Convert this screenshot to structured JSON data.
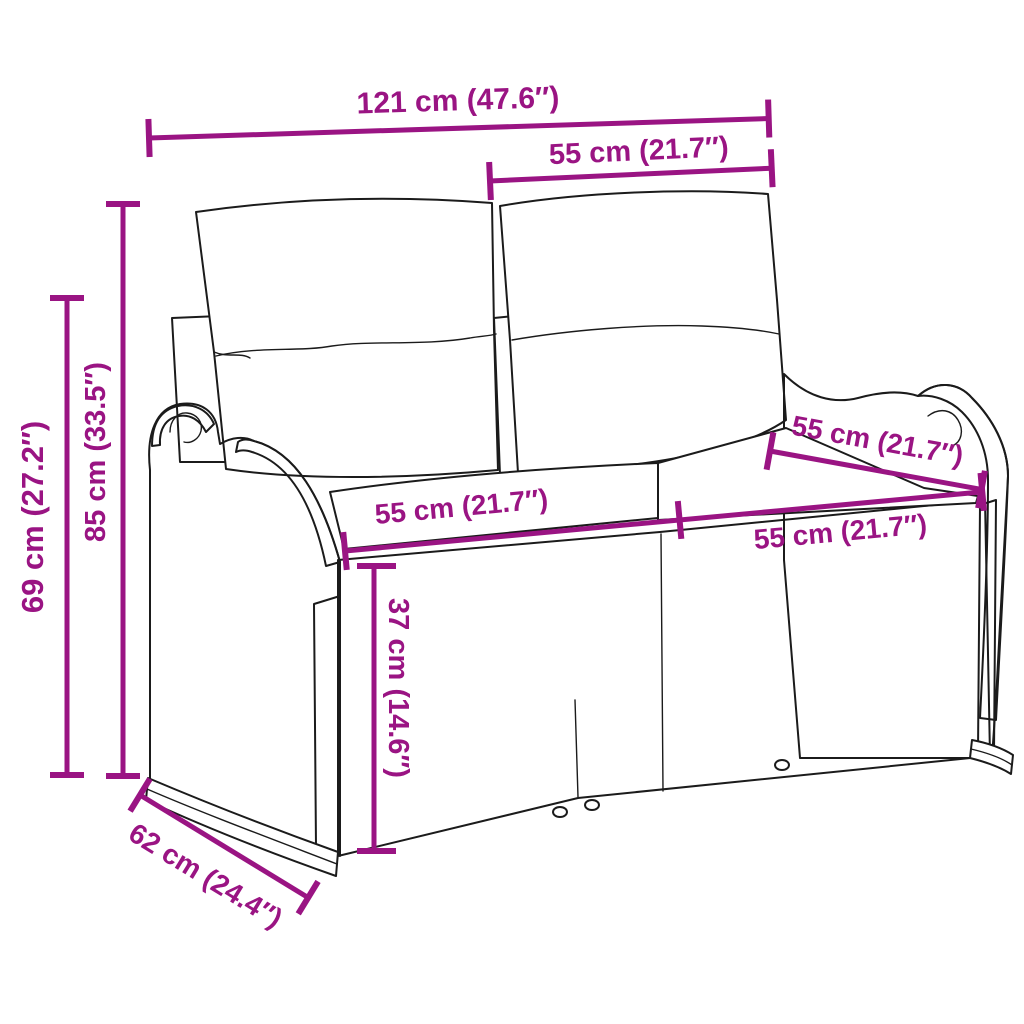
{
  "title": "Garden bench dimension diagram",
  "accent_color": "#9A1483",
  "outline_color": "#1b1b1b",
  "subject": "two-seater poly rattan garden bench with back and seat cushions",
  "dims": {
    "width_total": {
      "label": "121 cm (47.6″)"
    },
    "width_back_half": {
      "label": "55 cm (21.7″)"
    },
    "height_back": {
      "label": "85 cm (33.5″)"
    },
    "height_arm": {
      "label": "69 cm (27.2″)"
    },
    "depth_seat": {
      "label": "55 cm (21.7″)"
    },
    "width_seat_left": {
      "label": "55 cm (21.7″)"
    },
    "width_seat_right": {
      "label": "55 cm (21.7″)"
    },
    "height_seat": {
      "label": "37 cm (14.6″)"
    },
    "depth_total": {
      "label": "62 cm (24.4″)"
    }
  }
}
